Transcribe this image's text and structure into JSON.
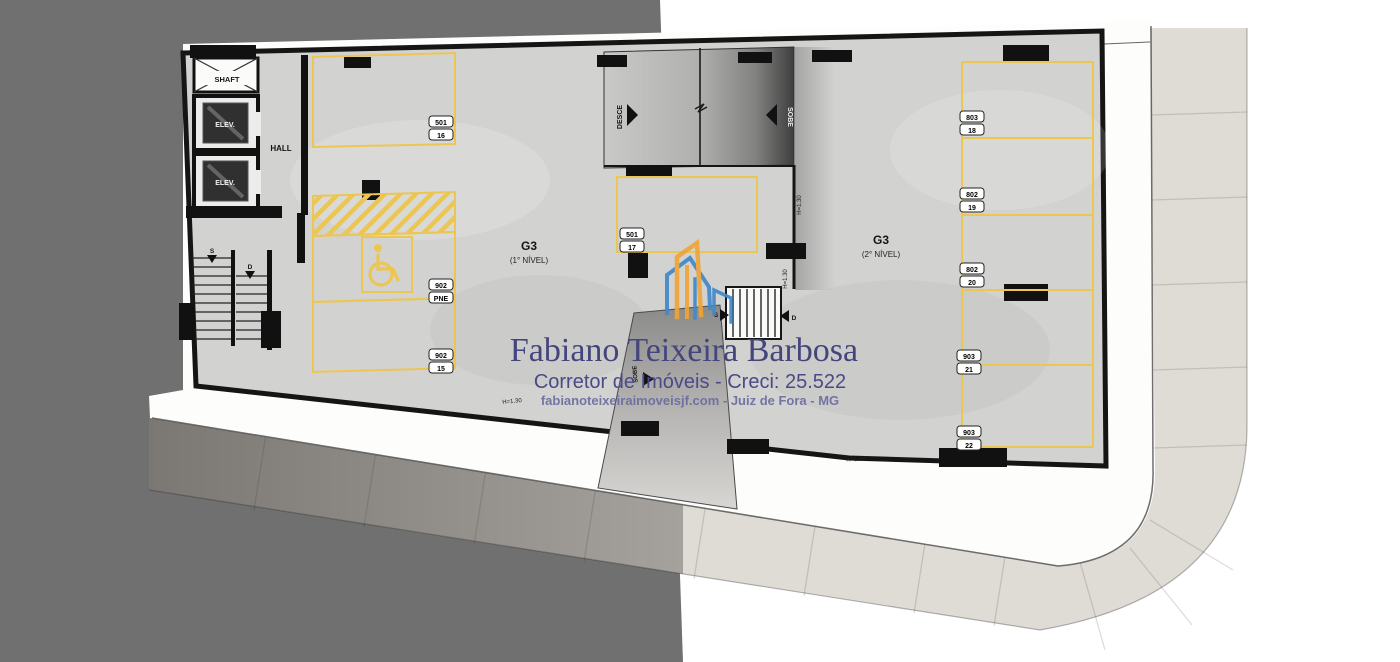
{
  "watermark": {
    "name": "Fabiano Teixeira Barbosa",
    "title": "Corretor de Imóveis - Creci: 25.522",
    "website": "fabianoteixeiraimoveisjf.com - Juiz de Fora - MG"
  },
  "plan": {
    "level1": {
      "code": "G3",
      "name": "(1° NÍVEL)"
    },
    "level2": {
      "code": "G3",
      "name": "(2° NÍVEL)"
    },
    "core": {
      "shaft": "SHAFT",
      "elev1": "ELEV.",
      "elev2": "ELEV.",
      "hall": "HALL"
    },
    "ramp": {
      "desce": "DESCE",
      "sobe": "SOBE",
      "entrance": "SOBE"
    },
    "stairs": {
      "up": "S",
      "down": "D"
    },
    "clearance": "H=1.30",
    "spots": [
      {
        "unit": "501",
        "number": "16"
      },
      {
        "unit": "902",
        "number": "PNE"
      },
      {
        "unit": "902",
        "number": "15"
      },
      {
        "unit": "501",
        "number": "17"
      },
      {
        "unit": "803",
        "number": "18"
      },
      {
        "unit": "802",
        "number": "19"
      },
      {
        "unit": "802",
        "number": "20"
      },
      {
        "unit": "903",
        "number": "21"
      },
      {
        "unit": "903",
        "number": "22"
      }
    ]
  },
  "colors": {
    "marking_yellow": "#ECC653",
    "overlay_gray": "#707070",
    "floor_gray": "#D2D2D1",
    "tile_light": "#DFDBD5",
    "watermark_purple": "#45457E",
    "logo_blue": "#4289C8",
    "logo_orange": "#F0A437"
  }
}
